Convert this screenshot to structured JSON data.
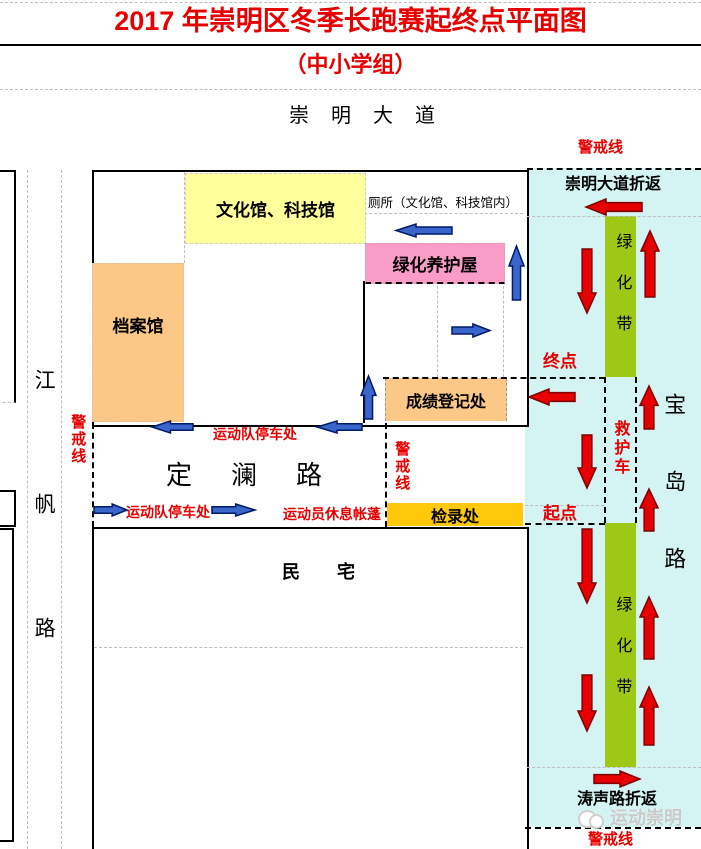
{
  "header": {
    "title": "2017 年崇明区冬季长跑赛起终点平面图",
    "subtitle": "（中小学组）"
  },
  "roads": {
    "chongming_avenue": "崇明大道",
    "jiangfan_road": "江帆路",
    "dinglan_road": "定澜路",
    "baodao_road": "宝岛路"
  },
  "buildings": {
    "culture_tech_hall": "文化馆、科技馆",
    "archives_hall": "档案馆",
    "green_maintenance_house": "绿化养护屋",
    "score_registration": "成绩登记处",
    "check_in": "检录处",
    "residential": "民宅"
  },
  "labels": {
    "cordon_line": "警戒线",
    "chongming_avenue_turnaround": "崇明大道折返",
    "taosheng_road_turnaround": "涛声路折返",
    "finish_point": "终点",
    "start_point": "起点",
    "ambulance": "救护车",
    "green_belt": "绿化带",
    "team_parking": "运动队停车处",
    "athlete_rest_tent": "运动员休息帐蓬",
    "toilet_note": "厕所（文化馆、科技馆内）"
  },
  "watermark": {
    "text": "运动崇明"
  },
  "colors": {
    "accent_red": "#e60000",
    "route_arrow": "#e60000",
    "route_arrow_outline": "#7f0000",
    "flow_arrow": "#3a66cc",
    "flow_arrow_outline": "#001a66",
    "cyan_zone": "#d4f3f3",
    "green_belt": "#9dc916",
    "culture_hall_fill": "#ffff9c",
    "archives_fill": "#fbc888",
    "maintenance_fill": "#fa9cc8",
    "score_box_fill": "#fbc888",
    "checkin_fill": "#ffc80a"
  }
}
